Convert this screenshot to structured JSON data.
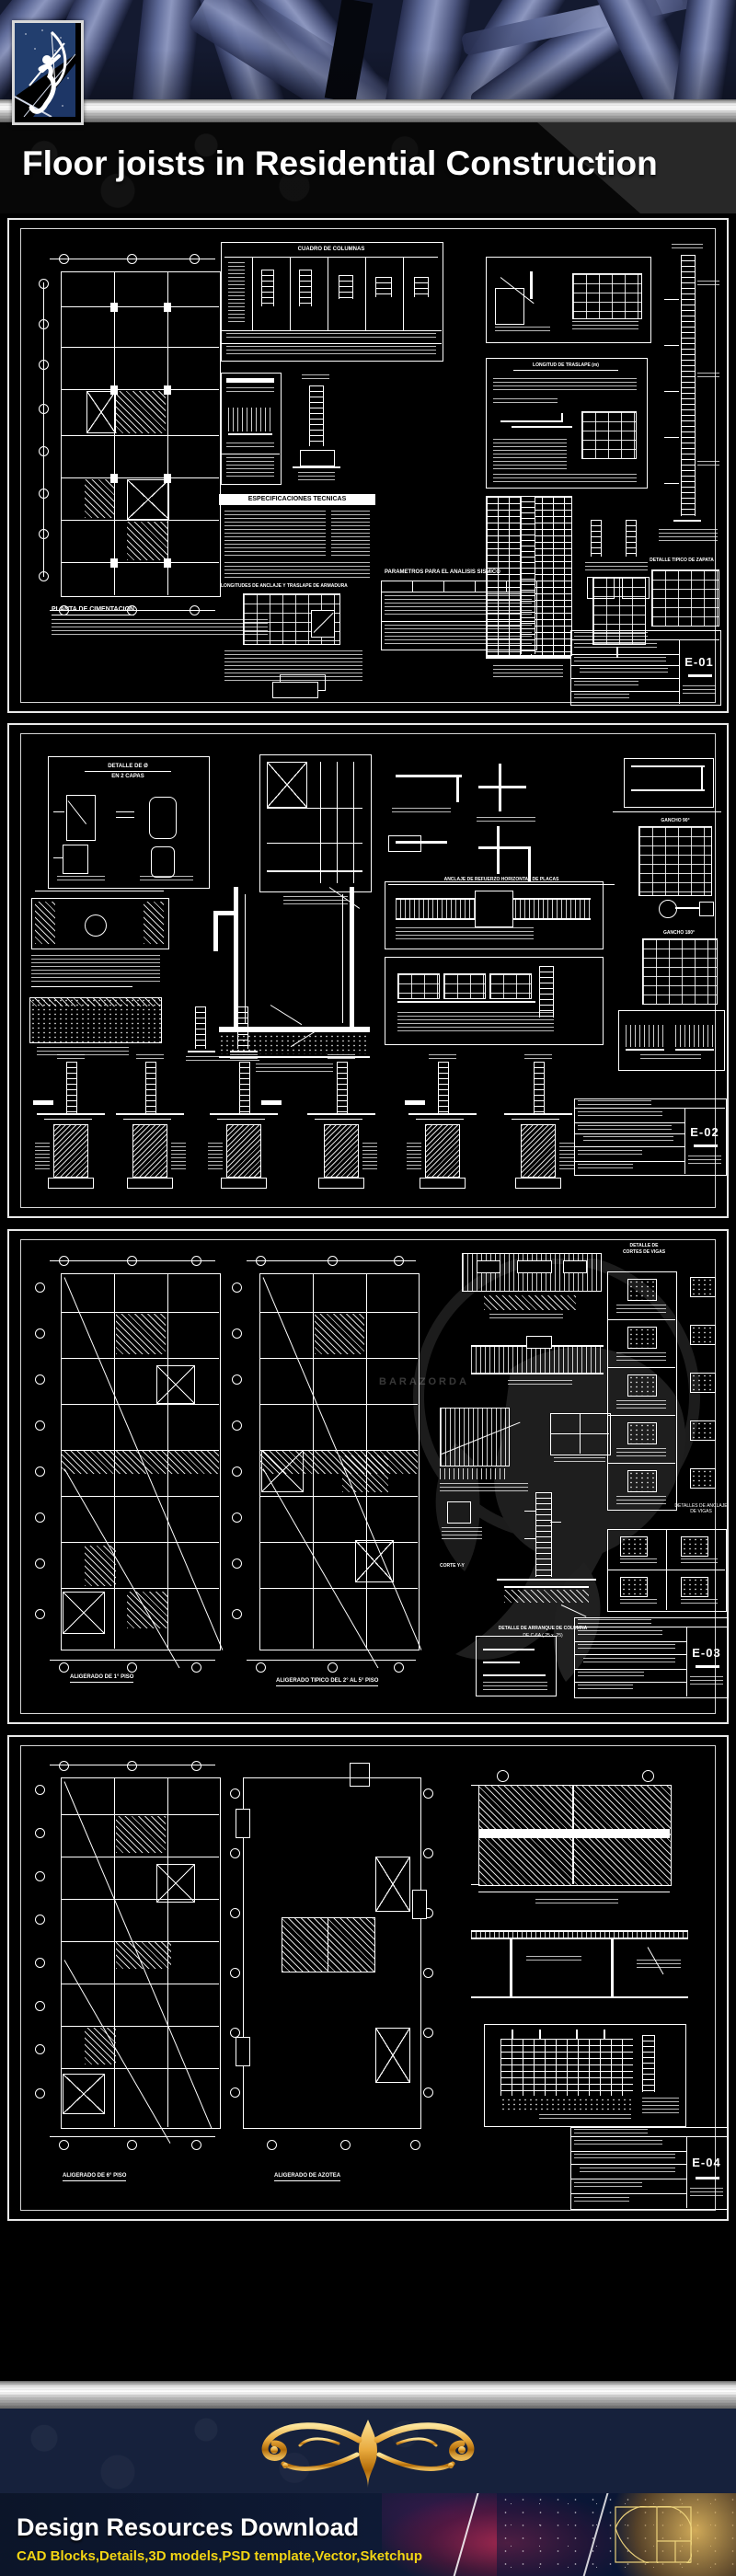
{
  "title": {
    "text": "Floor joists in Residential Construction"
  },
  "header": {
    "logo": "archer-logo"
  },
  "sheets": {
    "e01": {
      "number": "E-01",
      "cuadro_columnas": "CUADRO DE COLUMNAS",
      "especificaciones": "ESPECIFICACIONES TECNICAS",
      "longitud_traslape": "LONGITUD DE TRASLAPE (m)",
      "anclaje_heading": "LONGITUDES DE ANCLAJE Y TRASLAPE DE ARMADURA",
      "planta": "PLANTA DE CIMENTACION",
      "parametros": "PARAMETROS PARA EL ANALISIS SISMICO",
      "zapata": "DETALLE TIPICO DE ZAPATA"
    },
    "e02": {
      "number": "E-02",
      "detalle_capas_1": "DETALLE DE Ø",
      "detalle_capas_2": "EN 2 CAPAS",
      "gancho_90": "GANCHO 90°",
      "gancho_180": "GANCHO 180°",
      "anclaje_placas": "ANCLAJE DE REFUERZO HORIZONTAL DE PLACAS"
    },
    "e03": {
      "number": "E-03",
      "cortes_vigas_1": "DETALLE DE",
      "cortes_vigas_2": "CORTES DE VIGAS",
      "anclaje_vigas": "DETALLES DE ANCLAJE DE VIGAS",
      "corte_yy": "CORTE Y-Y",
      "arranque_1": "DETALLE DE ARRANQUE DE COLUMNA",
      "arranque_2": "DE C-6A (.25 x .25)",
      "plan_1": "ALIGERADO DE 1° PISO",
      "plan_2": "ALIGERADO TIPICO DEL 2° AL 5° PISO",
      "watermark": "BARAZORDA"
    },
    "e04": {
      "number": "E-04",
      "plan_1": "ALIGERADO DE 6° PISO",
      "plan_2": "ALIGERADO DE AZOTEA"
    }
  },
  "footer": {
    "title": "Design Resources Download",
    "subtitle": "CAD Blocks,Details,3D models,PSD template,Vector,Sketchup"
  },
  "colors": {
    "accent_gold": "#e8b53c",
    "footer_subtitle_yellow": "#f3d513",
    "steel_blue": "#5f6d9d",
    "silver": "#c9c9c9",
    "navy": "#15203c",
    "cad_line": "#ffffff"
  }
}
